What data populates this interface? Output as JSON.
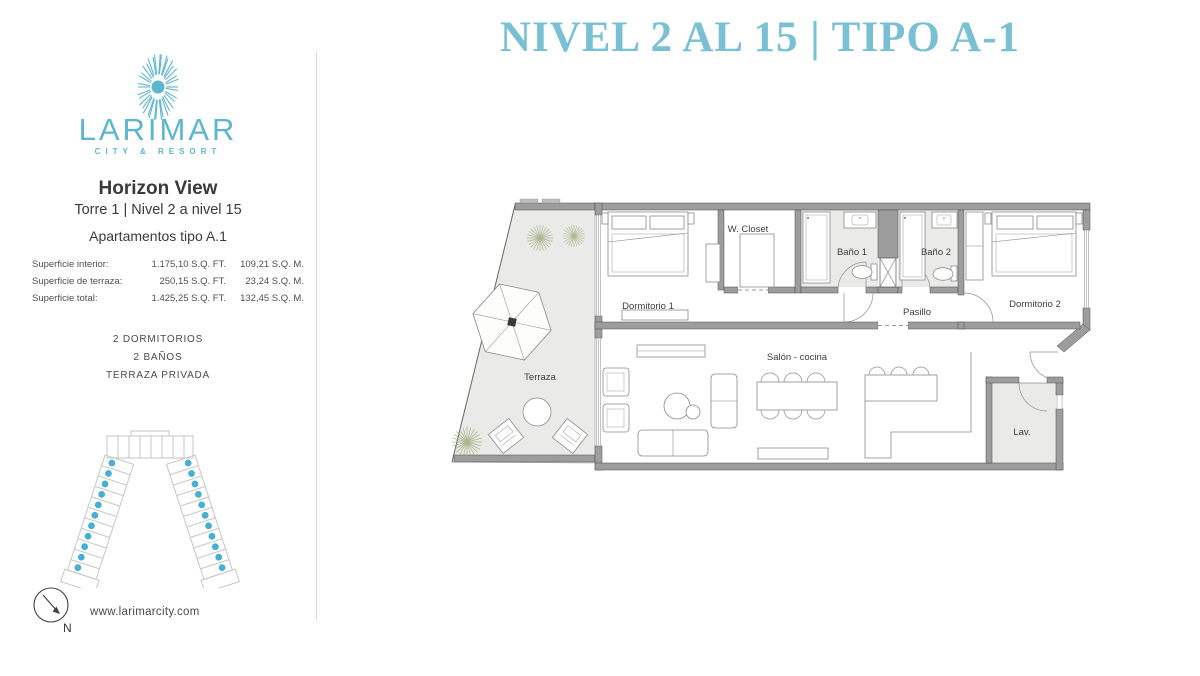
{
  "header": {
    "title": "NIVEL 2 AL 15 | TIPO A-1"
  },
  "brand": {
    "name": "LARIMAR",
    "tagline": "CITY & RESORT",
    "website": "www.larimarcity.com"
  },
  "sidebar": {
    "project": "Horizon View",
    "tower_levels": "Torre 1 | Nivel 2 a nivel 15",
    "apartment_type": "Apartamentos tipo A.1",
    "areas": [
      {
        "label": "Superficie interior:",
        "sqft": "1.175,10 S.Q. FT.",
        "sqm": "109,21 S.Q. M."
      },
      {
        "label": "Superficie de terraza:",
        "sqft": "250,15 S.Q. FT.",
        "sqm": "23,24 S.Q. M."
      },
      {
        "label": "Superficie total:",
        "sqft": "1.425,25 S.Q. FT.",
        "sqm": "132,45 S.Q. M."
      }
    ],
    "features": [
      "2 DORMITORIOS",
      "2 BAÑOS",
      "TERRAZA PRIVADA"
    ],
    "compass_north": "N"
  },
  "floorplan": {
    "labels": {
      "terraza": "Terraza",
      "dormitorio1": "Dormitorio 1",
      "wcloset": "W. Closet",
      "bano1": "Baño 1",
      "bano2": "Baño 2",
      "pasillo": "Pasillo",
      "dormitorio2": "Dormitorio 2",
      "salon": "Salón - cocina",
      "lav": "Lav."
    }
  },
  "colors": {
    "title_teal": "#7ac0d5",
    "logo_teal": "#5cb7ce",
    "unit_dot_blue": "#45b0d1",
    "wall_gray": "#9d9d9d",
    "floor_light_gray": "#eaeae8",
    "plant_green": "#9aaa79"
  }
}
